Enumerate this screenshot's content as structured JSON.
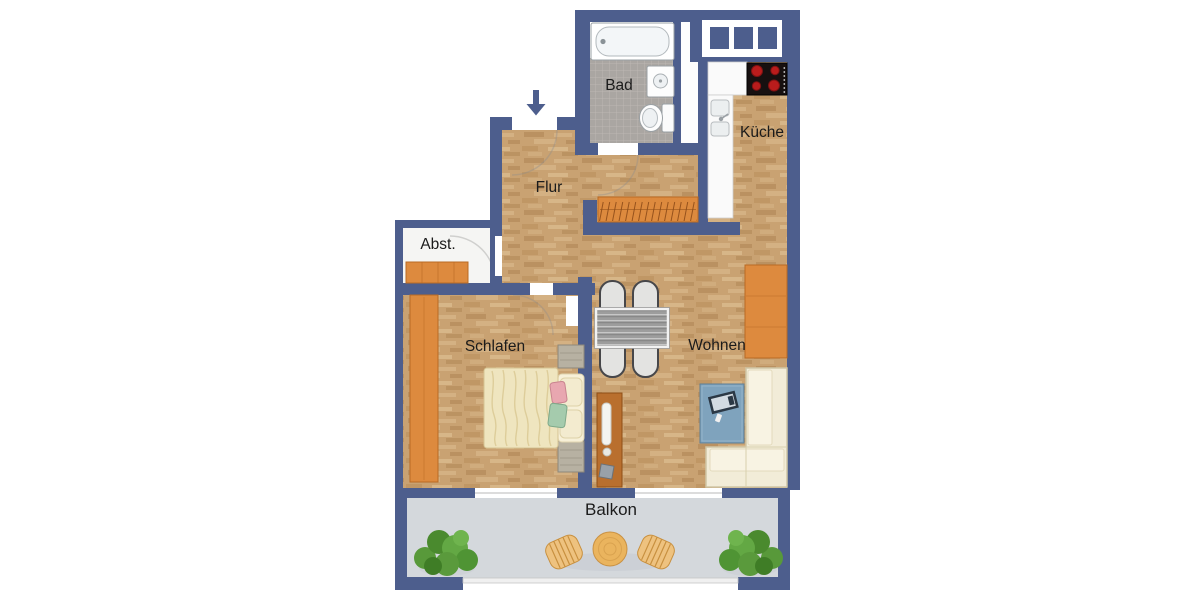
{
  "plan_type": "apartment-floor-plan",
  "rooms": {
    "bad": {
      "label": "Bad"
    },
    "kueche": {
      "label": "Küche"
    },
    "flur": {
      "label": "Flur"
    },
    "abstellraum": {
      "label": "Abst."
    },
    "schlafen": {
      "label": "Schlafen"
    },
    "wohnen": {
      "label": "Wohnen"
    },
    "balkon": {
      "label": "Balkon"
    }
  },
  "entrance": {
    "direction": "down"
  },
  "colors": {
    "wall": "#4d5e8d",
    "wood_floor": "#c9a272",
    "tile_floor": "#aaa6a2",
    "storage_floor": "#f5f5f3",
    "balcony_floor": "#d4d8dc",
    "furniture_orange": "#dd8a3e",
    "sideboard_brown": "#b96f2e",
    "bed_cream": "#efe5bf",
    "sofa_cream": "#f2ecd8",
    "tv_board_blue": "#7fa3bd",
    "stove_black": "#171010",
    "burner_red": "#b91c1c",
    "plant_green": "#5a9a3c",
    "balcony_wood": "#eab45e",
    "label_text": "#1b1b1b"
  },
  "furniture": [
    "bathtub",
    "wash-basin",
    "toilet",
    "stove",
    "kitchen-counter",
    "kitchen-sink",
    "coat-wardrobe",
    "storage-shelf",
    "bedroom-wardrobe",
    "double-bed",
    "nightstands",
    "dining-table",
    "dining-chairs",
    "sideboard",
    "tv-board",
    "tv",
    "corner-sofa",
    "highboard",
    "balcony-table",
    "balcony-chairs",
    "plants"
  ]
}
